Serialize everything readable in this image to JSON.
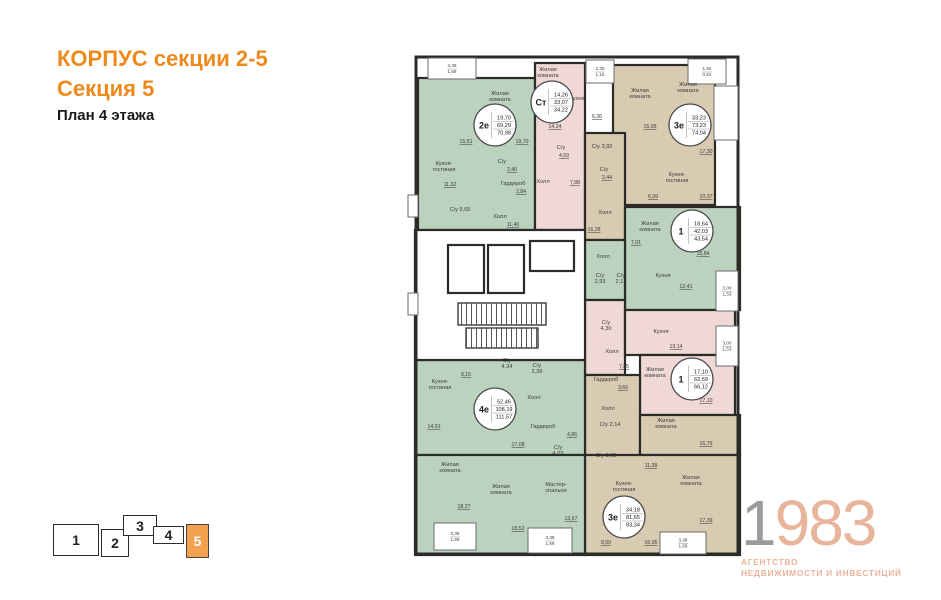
{
  "header": {
    "title_line1": "КОРПУС секции 2-5",
    "title_line2": "Секция 5",
    "subtitle": "План 4 этажа"
  },
  "colors": {
    "accent": "#EE8A1C",
    "section_active": "#F2A24F",
    "green": "#BBD3BE",
    "pink": "#EFD8D5",
    "tan": "#D9CBB1",
    "wall": "#2B2B28",
    "logo_gray": "#9B9B9B",
    "logo_peach": "#E9B49C"
  },
  "logo": {
    "digit_gray": "1",
    "digit_peach": "983",
    "tagline_line1": "АГЕНТСТВО",
    "tagline_line2": "НЕДВИЖИМОСТИ И ИНВЕСТИЦИЙ"
  },
  "section_nav": {
    "sections": [
      {
        "label": "1",
        "x": 53,
        "y": 524,
        "w": 46,
        "h": 32,
        "active": false
      },
      {
        "label": "2",
        "x": 101,
        "y": 529,
        "w": 28,
        "h": 28,
        "active": false
      },
      {
        "label": "3",
        "x": 123,
        "y": 515,
        "w": 34,
        "h": 21,
        "active": false
      },
      {
        "label": "4",
        "x": 153,
        "y": 526,
        "w": 31,
        "h": 18,
        "active": false
      },
      {
        "label": "5",
        "x": 186,
        "y": 524,
        "w": 23,
        "h": 34,
        "active": true
      }
    ]
  },
  "floorplan": {
    "outline": {
      "x": 16,
      "y": 12,
      "w": 322,
      "h": 497
    },
    "regions": [
      {
        "c": "green",
        "x": 18,
        "y": 33,
        "w": 117,
        "h": 152
      },
      {
        "c": "pink",
        "x": 135,
        "y": 18,
        "w": 50,
        "h": 167
      },
      {
        "c": "tan",
        "x": 213,
        "y": 20,
        "w": 102,
        "h": 140
      },
      {
        "c": "tan",
        "x": 185,
        "y": 88,
        "w": 40,
        "h": 107
      },
      {
        "c": "green",
        "x": 225,
        "y": 162,
        "w": 115,
        "h": 103
      },
      {
        "c": "green",
        "x": 185,
        "y": 195,
        "w": 40,
        "h": 60
      },
      {
        "c": "pink",
        "x": 185,
        "y": 255,
        "w": 40,
        "h": 75
      },
      {
        "c": "pink",
        "x": 225,
        "y": 265,
        "w": 110,
        "h": 45
      },
      {
        "c": "pink",
        "x": 240,
        "y": 310,
        "w": 95,
        "h": 60
      },
      {
        "c": "tan",
        "x": 185,
        "y": 330,
        "w": 55,
        "h": 85
      },
      {
        "c": "tan",
        "x": 240,
        "y": 370,
        "w": 100,
        "h": 40
      },
      {
        "c": "tan",
        "x": 185,
        "y": 410,
        "w": 155,
        "h": 100
      },
      {
        "c": "green",
        "x": 15,
        "y": 315,
        "w": 170,
        "h": 95
      },
      {
        "c": "green",
        "x": 15,
        "y": 410,
        "w": 170,
        "h": 100
      }
    ],
    "core": {
      "outline": {
        "x": 15,
        "y": 185,
        "w": 170,
        "h": 130
      },
      "elevators": [
        [
          48,
          200,
          36,
          48
        ],
        [
          88,
          200,
          36,
          48
        ],
        [
          130,
          196,
          44,
          30
        ]
      ],
      "stairs": [
        [
          58,
          258,
          88,
          22
        ],
        [
          66,
          283,
          72,
          20
        ]
      ]
    },
    "balconies": [
      {
        "x": 28,
        "y": 13,
        "w": 48,
        "h": 21,
        "v": [
          "3,38",
          "1,69"
        ]
      },
      {
        "x": 186,
        "y": 15,
        "w": 28,
        "h": 23,
        "v": [
          "2,30",
          "1,15"
        ]
      },
      {
        "x": 288,
        "y": 14,
        "w": 38,
        "h": 25,
        "v": [
          "1,62",
          "0,81"
        ]
      },
      {
        "x": 314,
        "y": 41,
        "w": 24,
        "h": 54,
        "v": []
      },
      {
        "x": 316,
        "y": 226,
        "w": 22,
        "h": 40,
        "v": [
          "3,00",
          "1,53"
        ]
      },
      {
        "x": 316,
        "y": 281,
        "w": 22,
        "h": 40,
        "v": [
          "3,00",
          "1,53"
        ]
      },
      {
        "x": 34,
        "y": 478,
        "w": 42,
        "h": 27,
        "v": [
          "3,38",
          "1,69"
        ]
      },
      {
        "x": 128,
        "y": 483,
        "w": 44,
        "h": 25,
        "v": [
          "3,38",
          "1,69"
        ]
      },
      {
        "x": 260,
        "y": 487,
        "w": 46,
        "h": 22,
        "v": [
          "3,38",
          "1,69"
        ]
      },
      {
        "x": 8,
        "y": 150,
        "w": 10,
        "h": 22,
        "v": []
      },
      {
        "x": 8,
        "y": 248,
        "w": 10,
        "h": 22,
        "v": []
      }
    ],
    "apartments": [
      {
        "type": "2е",
        "areas": [
          "19,70",
          "69,29",
          "70,98"
        ],
        "cx": 95,
        "cy": 80
      },
      {
        "type": "Ст",
        "areas": [
          "14,26",
          "33,07",
          "34,22"
        ],
        "cx": 152,
        "cy": 57
      },
      {
        "type": "3е",
        "areas": [
          "33,23",
          "73,23",
          "74,04"
        ],
        "cx": 290,
        "cy": 80
      },
      {
        "type": "1",
        "areas": [
          "18,64",
          "42,03",
          "43,54"
        ],
        "cx": 292,
        "cy": 186
      },
      {
        "type": "1",
        "areas": [
          "17,10",
          "62,59",
          "66,12"
        ],
        "cx": 292,
        "cy": 334
      },
      {
        "type": "4е",
        "areas": [
          "52,46",
          "108,19",
          "111,57"
        ],
        "cx": 95,
        "cy": 364
      },
      {
        "type": "3е",
        "areas": [
          "34,18",
          "81,65",
          "83,34"
        ],
        "cx": 224,
        "cy": 472
      }
    ],
    "labels": [
      {
        "t": "Жилая\nкомната",
        "x": 100,
        "y": 50
      },
      {
        "t": "15,51",
        "x": 66,
        "y": 98,
        "u": 1
      },
      {
        "t": "19,70",
        "x": 122,
        "y": 98,
        "u": 1
      },
      {
        "t": "Кухня-\nгостиная",
        "x": 44,
        "y": 120
      },
      {
        "t": "11,32",
        "x": 50,
        "y": 141,
        "u": 1
      },
      {
        "t": "С/у 5,65",
        "x": 60,
        "y": 166
      },
      {
        "t": "С/у",
        "x": 102,
        "y": 118
      },
      {
        "t": "2,40",
        "x": 112,
        "y": 126,
        "u": 1
      },
      {
        "t": "Гардероб",
        "x": 113,
        "y": 140
      },
      {
        "t": "2,84",
        "x": 121,
        "y": 148,
        "u": 1
      },
      {
        "t": "Холл",
        "x": 100,
        "y": 173
      },
      {
        "t": "11,40",
        "x": 113,
        "y": 181,
        "u": 1
      },
      {
        "t": "Жилая\nкомната",
        "x": 148,
        "y": 26
      },
      {
        "t": "Кухня",
        "x": 177,
        "y": 55
      },
      {
        "t": "6,36",
        "x": 197,
        "y": 73,
        "u": 1
      },
      {
        "t": "14,24",
        "x": 155,
        "y": 83,
        "u": 1
      },
      {
        "t": "С/у",
        "x": 161,
        "y": 104
      },
      {
        "t": "4,59",
        "x": 164,
        "y": 112,
        "u": 1
      },
      {
        "t": "Холл",
        "x": 143,
        "y": 138
      },
      {
        "t": "7,88",
        "x": 175,
        "y": 139,
        "u": 1
      },
      {
        "t": "Жилая\nкомната",
        "x": 240,
        "y": 47
      },
      {
        "t": "15,95",
        "x": 250,
        "y": 83,
        "u": 1
      },
      {
        "t": "Жилая\nкомната",
        "x": 288,
        "y": 41
      },
      {
        "t": "17,30",
        "x": 306,
        "y": 108,
        "u": 1
      },
      {
        "t": "Кухня-\nгостиная",
        "x": 277,
        "y": 131
      },
      {
        "t": "6,99",
        "x": 253,
        "y": 153,
        "u": 1
      },
      {
        "t": "10,37",
        "x": 306,
        "y": 153,
        "u": 1
      },
      {
        "t": "С/у 3,92",
        "x": 202,
        "y": 103
      },
      {
        "t": "С/у",
        "x": 204,
        "y": 126
      },
      {
        "t": "2,44",
        "x": 207,
        "y": 134,
        "u": 1
      },
      {
        "t": "Холл",
        "x": 205,
        "y": 169
      },
      {
        "t": "16,28",
        "x": 194,
        "y": 186,
        "u": 1
      },
      {
        "t": "Жилая\nкомната",
        "x": 250,
        "y": 180
      },
      {
        "t": "7,01",
        "x": 236,
        "y": 199,
        "u": 1
      },
      {
        "t": "16,84",
        "x": 303,
        "y": 210,
        "u": 1
      },
      {
        "t": "Холл",
        "x": 203,
        "y": 213
      },
      {
        "t": "С/у\n2,93",
        "x": 200,
        "y": 232
      },
      {
        "t": "С/у\n2,12",
        "x": 221,
        "y": 232
      },
      {
        "t": "Кухня",
        "x": 263,
        "y": 232
      },
      {
        "t": "12,41",
        "x": 286,
        "y": 243,
        "u": 1
      },
      {
        "t": "Кухня",
        "x": 261,
        "y": 288
      },
      {
        "t": "13,14",
        "x": 276,
        "y": 303,
        "u": 1
      },
      {
        "t": "С/у\n4,30",
        "x": 206,
        "y": 279
      },
      {
        "t": "Холл",
        "x": 212,
        "y": 308
      },
      {
        "t": "7,85",
        "x": 224,
        "y": 323,
        "u": 1
      },
      {
        "t": "Жилая\nкомната",
        "x": 255,
        "y": 326
      },
      {
        "t": "17,10",
        "x": 306,
        "y": 357,
        "u": 1
      },
      {
        "t": "8,15",
        "x": 66,
        "y": 331,
        "u": 1
      },
      {
        "t": "Кухня-\nгостиная",
        "x": 40,
        "y": 338
      },
      {
        "t": "14,91",
        "x": 34,
        "y": 383,
        "u": 1
      },
      {
        "t": "С/у\n4,34",
        "x": 107,
        "y": 317
      },
      {
        "t": "С/у\n2,36",
        "x": 137,
        "y": 322
      },
      {
        "t": "Холл",
        "x": 134,
        "y": 354
      },
      {
        "t": "Гардероб",
        "x": 143,
        "y": 383
      },
      {
        "t": "4,86",
        "x": 172,
        "y": 391,
        "u": 1
      },
      {
        "t": "17,08",
        "x": 118,
        "y": 401,
        "u": 1
      },
      {
        "t": "С/у\n4,03",
        "x": 158,
        "y": 404
      },
      {
        "t": "Жилая\nкомната",
        "x": 50,
        "y": 421
      },
      {
        "t": "18,27",
        "x": 64,
        "y": 463,
        "u": 1
      },
      {
        "t": "Жилая\nкомната",
        "x": 101,
        "y": 443
      },
      {
        "t": "18,52",
        "x": 118,
        "y": 485,
        "u": 1
      },
      {
        "t": "Мастер-\nспальня",
        "x": 156,
        "y": 441
      },
      {
        "t": "13,67",
        "x": 171,
        "y": 475,
        "u": 1
      },
      {
        "t": "Гардероб",
        "x": 206,
        "y": 336
      },
      {
        "t": "3,69",
        "x": 223,
        "y": 344,
        "u": 1
      },
      {
        "t": "Холл",
        "x": 208,
        "y": 365
      },
      {
        "t": "С/у 2,14",
        "x": 210,
        "y": 381
      },
      {
        "t": "С/у 3,65",
        "x": 206,
        "y": 412
      },
      {
        "t": "11,38",
        "x": 251,
        "y": 422,
        "u": 1
      },
      {
        "t": "Жилая\nкомната",
        "x": 266,
        "y": 377
      },
      {
        "t": "16,79",
        "x": 306,
        "y": 400,
        "u": 1
      },
      {
        "t": "Жилая\nкомната",
        "x": 291,
        "y": 434
      },
      {
        "t": "17,39",
        "x": 306,
        "y": 477,
        "u": 1
      },
      {
        "t": "Кухня-\nгостиная",
        "x": 224,
        "y": 440
      },
      {
        "t": "8,50",
        "x": 206,
        "y": 499,
        "u": 1
      },
      {
        "t": "16,95",
        "x": 251,
        "y": 499,
        "u": 1
      }
    ]
  }
}
